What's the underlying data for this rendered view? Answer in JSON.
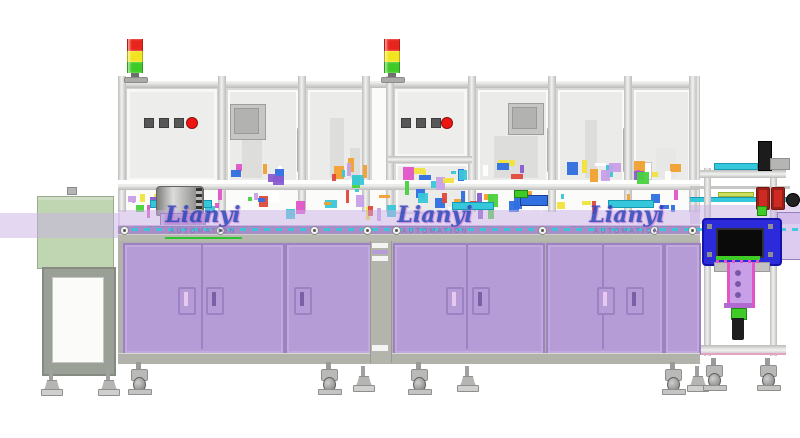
{
  "watermark": {
    "brand": "Lianyi",
    "subtitle": "AUTOMATION"
  },
  "signal_tower": {
    "lights": [
      "red",
      "yellow",
      "green"
    ]
  },
  "control_panels": {
    "square_buttons": 3,
    "stop_button": "red"
  },
  "equipment": {
    "modules": 2,
    "right_station": "blue-tunnel-unit",
    "left_station": "green-cover-outfeed",
    "palette": [
      "#e255c8",
      "#49d23e",
      "#f2e33c",
      "#39c7d8",
      "#8a5bd0",
      "#e0483c",
      "#2f6fe0",
      "#f0a030",
      "#ffffff",
      "#c9a0e8"
    ]
  },
  "colors": {
    "frame-light": "#f2f2f0",
    "frame-mid": "#d7d7d5",
    "frame-dark": "#bcbcba",
    "panel": "#ededeb",
    "window": "#ebebe9",
    "cabinet": "#b59cd6",
    "cabinet-border": "#9c82c2",
    "handle-slot": "#7d5fa8",
    "handle-slot-light": "#e8c8ee",
    "table": "#b7b9b1",
    "plinth": "#b1b3ab",
    "band-solid": "#a78ec7",
    "band-overlay": "rgba(200,175,228,0.5)",
    "stand-green": "rgba(176,202,158,0.8)",
    "tower-red": "#e8251c",
    "tower-yellow": "#f2e41e",
    "tower-green": "#3fca28",
    "button-red": "#ee1512",
    "button-dark": "#575757",
    "blue-unit": "#2b2bdc",
    "opening": "#0a0a0a",
    "column-purple": "#c9a0e8",
    "magenta": "#e255c8",
    "green": "#3fca28",
    "cyan": "#35c8dc",
    "wm-blue": "#2847b8",
    "wm-purple": "#837bba",
    "wm-underline": "#2ec42e"
  }
}
